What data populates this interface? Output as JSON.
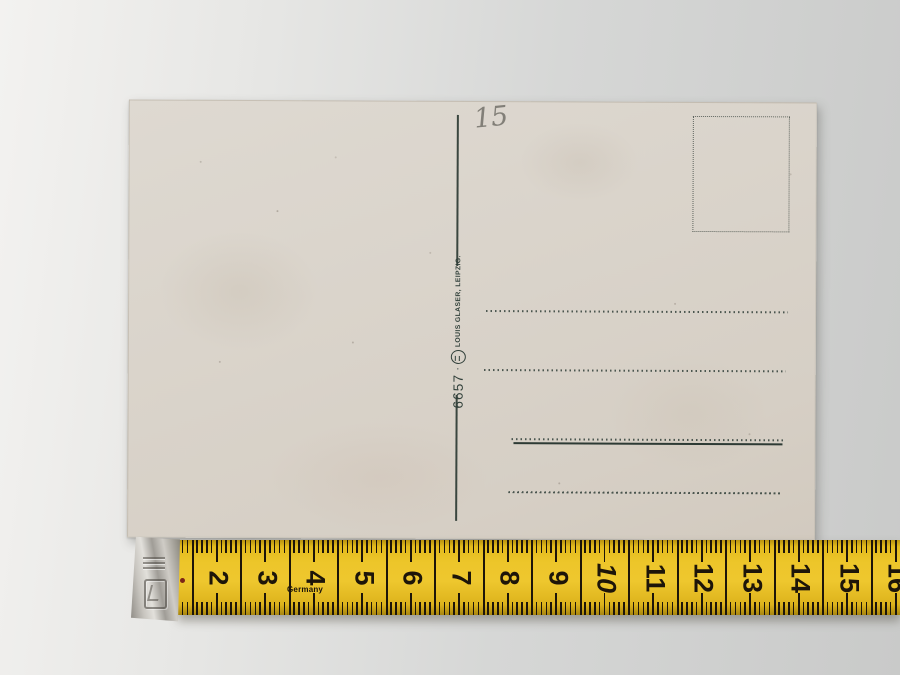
{
  "postcard": {
    "handwritten_number": "15",
    "imprint": {
      "number": "6657",
      "separator": "·",
      "publisher": "LOUIS GLASER, LEIPZIG."
    }
  },
  "tape": {
    "origin_label": "Germany",
    "numbers": [
      "2",
      "3",
      "4",
      "5",
      "6",
      "7",
      "8",
      "9",
      "10",
      "11",
      "12",
      "13",
      "14",
      "15",
      "16"
    ],
    "italic_numbers": [
      "10"
    ]
  },
  "colors": {
    "card_ink": "#31403a",
    "pencil_gray": "#827f78",
    "tape_yellow": "#edc62a",
    "tape_marks": "#1d1509"
  }
}
